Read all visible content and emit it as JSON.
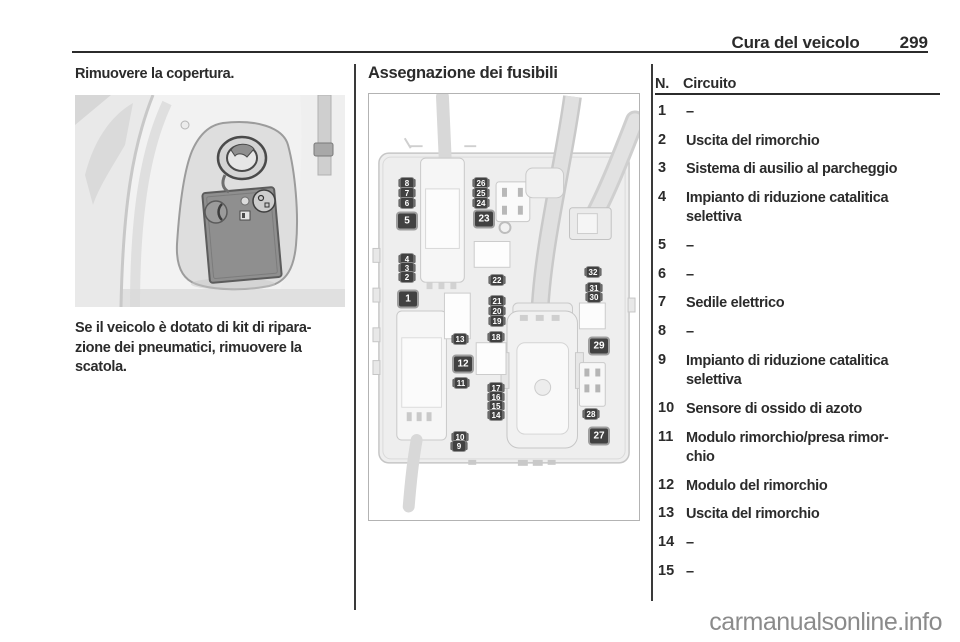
{
  "page": {
    "header": {
      "section_title": "Cura del veicolo",
      "page_number": "299"
    },
    "watermark": "carmanualsonline.info"
  },
  "left_column": {
    "intro": "Rimuovere la copertura.",
    "paragraph_lines": [
      "Se il veicolo è dotato di kit di ripara-",
      "zione dei pneumatici, rimuovere la",
      "scatola."
    ]
  },
  "middle_column": {
    "heading": "Assegnazione dei fusibili",
    "figure": {
      "fuse_labels": [
        {
          "n": "8",
          "x": 38,
          "y": 89,
          "kind": "small"
        },
        {
          "n": "7",
          "x": 38,
          "y": 99,
          "kind": "small"
        },
        {
          "n": "6",
          "x": 38,
          "y": 109,
          "kind": "small"
        },
        {
          "n": "5",
          "x": 38,
          "y": 127,
          "kind": "box"
        },
        {
          "n": "4",
          "x": 38,
          "y": 165,
          "kind": "small"
        },
        {
          "n": "3",
          "x": 38,
          "y": 174,
          "kind": "small"
        },
        {
          "n": "2",
          "x": 38,
          "y": 183,
          "kind": "small"
        },
        {
          "n": "1",
          "x": 39,
          "y": 205,
          "kind": "box"
        },
        {
          "n": "26",
          "x": 112,
          "y": 89,
          "kind": "small"
        },
        {
          "n": "25",
          "x": 112,
          "y": 99,
          "kind": "small"
        },
        {
          "n": "24",
          "x": 112,
          "y": 109,
          "kind": "small"
        },
        {
          "n": "23",
          "x": 115,
          "y": 125,
          "kind": "box"
        },
        {
          "n": "22",
          "x": 128,
          "y": 186,
          "kind": "small"
        },
        {
          "n": "21",
          "x": 128,
          "y": 207,
          "kind": "small"
        },
        {
          "n": "20",
          "x": 128,
          "y": 217,
          "kind": "small"
        },
        {
          "n": "19",
          "x": 128,
          "y": 227,
          "kind": "small"
        },
        {
          "n": "13",
          "x": 91,
          "y": 245,
          "kind": "small"
        },
        {
          "n": "18",
          "x": 127,
          "y": 243,
          "kind": "small"
        },
        {
          "n": "12",
          "x": 94,
          "y": 270,
          "kind": "box"
        },
        {
          "n": "11",
          "x": 92,
          "y": 289,
          "kind": "small"
        },
        {
          "n": "17",
          "x": 127,
          "y": 294,
          "kind": "small"
        },
        {
          "n": "16",
          "x": 127,
          "y": 303,
          "kind": "small"
        },
        {
          "n": "15",
          "x": 127,
          "y": 312,
          "kind": "small"
        },
        {
          "n": "14",
          "x": 127,
          "y": 321,
          "kind": "small"
        },
        {
          "n": "10",
          "x": 91,
          "y": 343,
          "kind": "small"
        },
        {
          "n": "9",
          "x": 90,
          "y": 352,
          "kind": "small"
        },
        {
          "n": "32",
          "x": 224,
          "y": 178,
          "kind": "small"
        },
        {
          "n": "31",
          "x": 225,
          "y": 194,
          "kind": "small"
        },
        {
          "n": "30",
          "x": 225,
          "y": 203,
          "kind": "small"
        },
        {
          "n": "29",
          "x": 230,
          "y": 252,
          "kind": "box"
        },
        {
          "n": "28",
          "x": 222,
          "y": 320,
          "kind": "small"
        },
        {
          "n": "27",
          "x": 230,
          "y": 342,
          "kind": "box"
        }
      ]
    }
  },
  "right_column": {
    "table": {
      "col_number": "N.",
      "col_circuit": "Circuito",
      "rows": [
        {
          "n": "1",
          "lines": [
            "–"
          ]
        },
        {
          "n": "2",
          "lines": [
            "Uscita del rimorchio"
          ]
        },
        {
          "n": "3",
          "lines": [
            "Sistema di ausilio al parcheggio"
          ]
        },
        {
          "n": "4",
          "lines": [
            "Impianto di riduzione catalitica",
            "selettiva"
          ]
        },
        {
          "n": "5",
          "lines": [
            "–"
          ]
        },
        {
          "n": "6",
          "lines": [
            "–"
          ]
        },
        {
          "n": "7",
          "lines": [
            "Sedile elettrico"
          ]
        },
        {
          "n": "8",
          "lines": [
            "–"
          ]
        },
        {
          "n": "9",
          "lines": [
            "Impianto di riduzione catalitica",
            "selettiva"
          ]
        },
        {
          "n": "10",
          "lines": [
            "Sensore di ossido di azoto"
          ]
        },
        {
          "n": "11",
          "lines": [
            "Modulo rimorchio/presa rimor-",
            "chio"
          ]
        },
        {
          "n": "12",
          "lines": [
            "Modulo del rimorchio"
          ]
        },
        {
          "n": "13",
          "lines": [
            "Uscita del rimorchio"
          ]
        },
        {
          "n": "14",
          "lines": [
            "–"
          ]
        },
        {
          "n": "15",
          "lines": [
            "–"
          ]
        }
      ]
    }
  },
  "colors": {
    "text": "#2b2b2b",
    "rule": "#2b2b2b",
    "watermark": "#8b8b8b",
    "fuse_label_bg": "#414141"
  }
}
